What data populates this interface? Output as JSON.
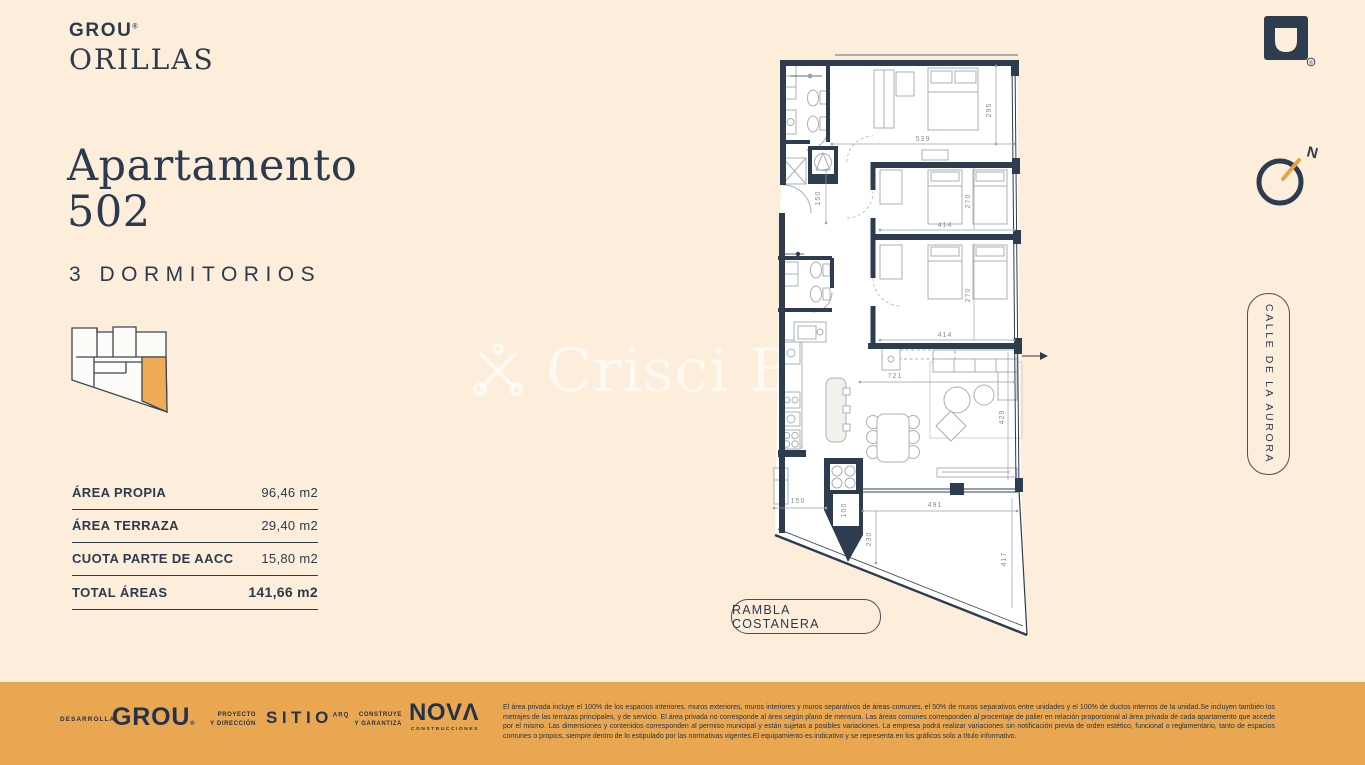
{
  "brand": {
    "name": "GROU",
    "reg": "®",
    "project": "ORILLAS"
  },
  "header": {
    "title_line1": "Apartamento",
    "title_line2": "502",
    "subtitle": "3 DORMITORIOS"
  },
  "areas": {
    "rows": [
      {
        "label": "ÁREA PROPIA",
        "value": "96,46 m2"
      },
      {
        "label": "ÁREA TERRAZA",
        "value": "29,40 m2"
      },
      {
        "label": "CUOTA PARTE DE AACC",
        "value": "15,80 m2"
      },
      {
        "label": "TOTAL ÁREAS",
        "value": "141,66 m2"
      }
    ]
  },
  "plan": {
    "dims": {
      "master_w": "539",
      "master_h": "295",
      "bed2_w": "414",
      "bed2_h": "270",
      "bed3_w": "414",
      "bed3_h": "270",
      "living_w": "721",
      "living_h": "429",
      "terrace_w": "491",
      "terrace_left": "230",
      "terrace_right": "417",
      "hall": "150",
      "service": "150",
      "grill": "100"
    },
    "compass_n": "N",
    "street_bottom": "RAMBLA COSTANERA",
    "street_right": "CALLE DE LA AURORA"
  },
  "watermark": {
    "text": "Crisci Bla"
  },
  "footer": {
    "developer_label": "DESARROLLA",
    "developer_name": "GROU",
    "developer_reg": "®",
    "architect_label1": "PROYECTO",
    "architect_label2": "Y DIRECCIÓN",
    "architect_name": "SITIO",
    "architect_sup": "ARQ",
    "builder_label1": "CONSTRUYE",
    "builder_label2": "Y GARANTIZA",
    "builder_name": "NOVΛ",
    "builder_sub": "CONSTRUCCIONES",
    "legal": "El área privada incluye el 100% de los espacios interiores, muros exteriores, muros interiores y muros separativos de áreas comunes, el 50% de muros separativos entre unidades y el 100% de ductos internos de la unidad.Se incluyen también los metrajes de las terrazas principales, y de servicio. El área privada no corresponde al área según plano de mensura. Las áreas comunes corresponden al procentaje de palier en relación proporcional al área privada de cada apartamento que accede por el mismo. Las dimensiones y contenidos corresponden al permiso municipal y están sujetas a posibles variaciones. La empresa podrá realizar variaciones sin notificación previa de orden estético, funcional o reglamentario, tanto de espacios comunes o propios, siempre dentro de lo estipulado por las normativas vigentes.El equipamiento es indicativo y se representa en los gráficos solo a título informativo."
  },
  "colors": {
    "background": "#FCEEDA",
    "navy": "#2C3A4D",
    "footer_orange": "#E9A751",
    "unit_highlight": "#EFAC55"
  }
}
